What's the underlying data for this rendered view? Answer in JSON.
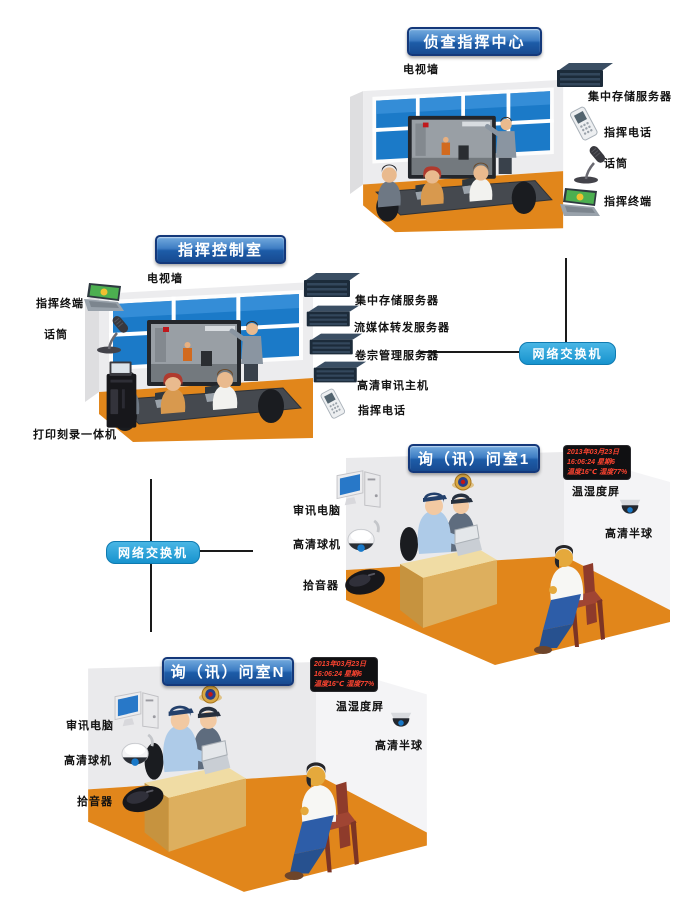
{
  "colors": {
    "floor_orange": "#E1861B",
    "wall_gray": "#EAEAEC",
    "switch_blue": "#1C9AD6",
    "title_blue": "#1D5CA8",
    "window_blue": "#1B7AC8",
    "led_red": "#FF4430"
  },
  "switches": {
    "right_label": "网络交换机",
    "left_label": "网络交换机"
  },
  "command_center": {
    "title": "侦查指挥中心",
    "labels": {
      "tv_wall": "电视墙",
      "storage": "集中存储服务器",
      "phone": "指挥电话",
      "mic": "话筒",
      "terminal": "指挥终端"
    }
  },
  "control_room": {
    "title": "指挥控制室",
    "labels": {
      "tv_wall": "电视墙",
      "terminal": "指挥终端",
      "mic": "话筒",
      "printer": "打印刻录一体机",
      "storage": "集中存储服务器",
      "stream": "流媒体转发服务器",
      "archive": "卷宗管理服务器",
      "hd_host": "高清审讯主机",
      "phone": "指挥电话"
    }
  },
  "room1": {
    "title": "询（讯）问室1",
    "labels": {
      "computer": "审讯电脑",
      "ball_camera": "高清球机",
      "pickup": "拾音器",
      "temp_humidity_screen": "温湿度屏",
      "half_dome": "高清半球"
    },
    "led": {
      "date": "2013年03月23日",
      "time": "16:06:24 星期6",
      "temp": "温度16℃ 湿度77%"
    }
  },
  "roomN": {
    "title": "询（讯）问室N",
    "labels": {
      "computer": "审讯电脑",
      "ball_camera": "高清球机",
      "pickup": "拾音器",
      "temp_humidity_screen": "温湿度屏",
      "half_dome": "高清半球"
    },
    "led": {
      "date": "2013年03月23日",
      "time": "16:06:24 星期6",
      "temp": "温度16℃ 湿度77%"
    }
  }
}
